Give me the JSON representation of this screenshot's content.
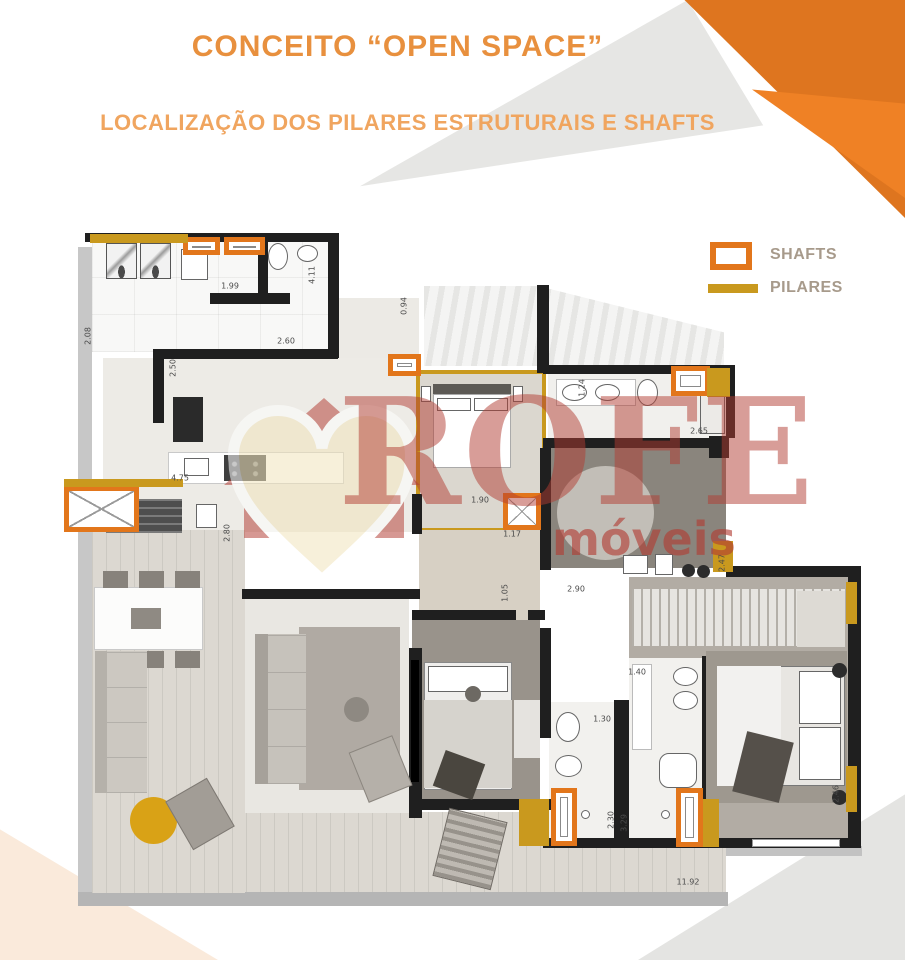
{
  "header": {
    "title": "CONCEITO “OPEN SPACE”",
    "subtitle": "LOCALIZAÇÃO DOS PILARES ESTRUTURAIS E SHAFTS"
  },
  "legend": {
    "shafts_label": "SHAFTS",
    "pilares_label": "PILARES"
  },
  "watermark": {
    "brand": "ROFE",
    "brand_sub": "móveis"
  },
  "colors": {
    "orange_shaft": "#e2761b",
    "orange_corner_dark": "#de751f",
    "orange_corner_light": "#ef8125",
    "gold_pilar": "#c9991e",
    "title_orange": "#e8903e",
    "subtitle_orange": "#f0a55f",
    "legend_text": "#a79a8b",
    "watermark_red": "#b13c32",
    "wall_black": "#1f1f1f",
    "gold_ottoman": "#d9a216"
  },
  "plan": {
    "dimension_labels": [
      {
        "text": "1.99",
        "x": 230,
        "y": 286,
        "rot": 0
      },
      {
        "text": "4.11",
        "x": 312,
        "y": 275,
        "rot": -90
      },
      {
        "text": "2.08",
        "x": 88,
        "y": 336,
        "rot": -90
      },
      {
        "text": "2.60",
        "x": 286,
        "y": 341,
        "rot": 0
      },
      {
        "text": "2.50",
        "x": 173,
        "y": 368,
        "rot": -90
      },
      {
        "text": "0.94",
        "x": 404,
        "y": 306,
        "rot": -90
      },
      {
        "text": "4.75",
        "x": 180,
        "y": 478,
        "rot": 0
      },
      {
        "text": "2.80",
        "x": 227,
        "y": 533,
        "rot": -90
      },
      {
        "text": "1.90",
        "x": 480,
        "y": 500,
        "rot": 0
      },
      {
        "text": "1.17",
        "x": 512,
        "y": 534,
        "rot": 0
      },
      {
        "text": "1.05",
        "x": 505,
        "y": 593,
        "rot": -90
      },
      {
        "text": "2.90",
        "x": 576,
        "y": 589,
        "rot": 0
      },
      {
        "text": "1.24",
        "x": 582,
        "y": 388,
        "rot": -90
      },
      {
        "text": "2.65",
        "x": 699,
        "y": 431,
        "rot": 0
      },
      {
        "text": "2.47",
        "x": 722,
        "y": 563,
        "rot": -90
      },
      {
        "text": "1.40",
        "x": 637,
        "y": 672,
        "rot": 0
      },
      {
        "text": "1.30",
        "x": 602,
        "y": 719,
        "rot": 0
      },
      {
        "text": "2.30",
        "x": 611,
        "y": 820,
        "rot": -90
      },
      {
        "text": "3.29",
        "x": 624,
        "y": 823,
        "rot": -90
      },
      {
        "text": "2.46",
        "x": 836,
        "y": 794,
        "rot": -90
      },
      {
        "text": "11.92",
        "x": 688,
        "y": 882,
        "rot": 0
      }
    ],
    "shafts": [
      {
        "x": 183,
        "y": 237,
        "w": 37,
        "h": 18,
        "style": "bar"
      },
      {
        "x": 224,
        "y": 237,
        "w": 41,
        "h": 18,
        "style": "bar"
      },
      {
        "x": 388,
        "y": 354,
        "w": 33,
        "h": 22,
        "style": "bar"
      },
      {
        "x": 671,
        "y": 366,
        "w": 39,
        "h": 30,
        "style": "bar"
      },
      {
        "x": 64,
        "y": 486,
        "w": 75,
        "h": 46,
        "style": "x"
      },
      {
        "x": 503,
        "y": 493,
        "w": 38,
        "h": 37,
        "style": "x"
      },
      {
        "x": 551,
        "y": 788,
        "w": 26,
        "h": 58,
        "style": "bar"
      },
      {
        "x": 676,
        "y": 788,
        "w": 27,
        "h": 59,
        "style": "bar"
      }
    ],
    "pilares": [
      {
        "x": 90,
        "y": 234,
        "w": 98,
        "h": 9
      },
      {
        "x": 64,
        "y": 479,
        "w": 119,
        "h": 8
      },
      {
        "x": 707,
        "y": 368,
        "w": 23,
        "h": 29
      },
      {
        "x": 713,
        "y": 541,
        "w": 20,
        "h": 31
      },
      {
        "x": 846,
        "y": 582,
        "w": 11,
        "h": 42
      },
      {
        "x": 846,
        "y": 766,
        "w": 11,
        "h": 46
      },
      {
        "x": 519,
        "y": 799,
        "w": 30,
        "h": 47
      },
      {
        "x": 703,
        "y": 799,
        "w": 16,
        "h": 48
      }
    ]
  }
}
